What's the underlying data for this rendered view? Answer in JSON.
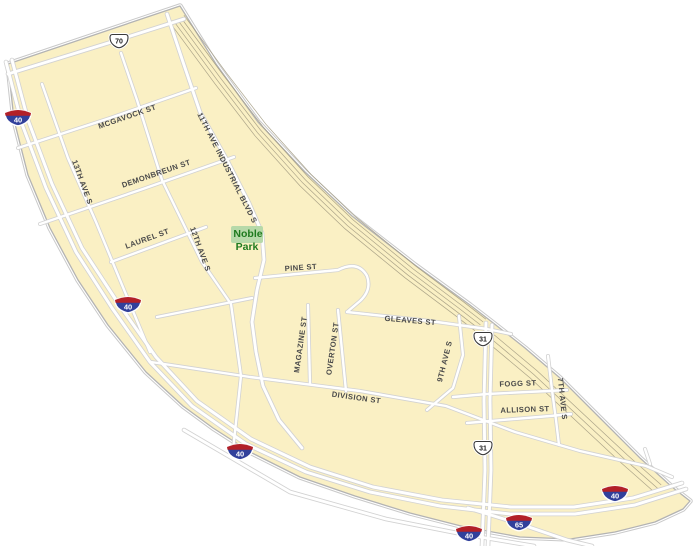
{
  "map": {
    "park": {
      "line1": "Noble",
      "line2": "Park"
    },
    "street_labels": [
      {
        "text": "MCGAVOCK ST",
        "x": 128,
        "y": 119,
        "rotate": -19
      },
      {
        "text": "DEMONBREUN ST",
        "x": 157,
        "y": 176,
        "rotate": -19
      },
      {
        "text": "LAUREL ST",
        "x": 148,
        "y": 241,
        "rotate": -20
      },
      {
        "text": "13TH AVE S",
        "x": 80,
        "y": 183,
        "rotate": 70
      },
      {
        "text": "12TH AVE S",
        "x": 198,
        "y": 250,
        "rotate": 70
      },
      {
        "text": "11TH AVE INDUSTRIAL BLVD S",
        "x": 225,
        "y": 169,
        "rotate": 63
      },
      {
        "text": "PINE ST",
        "x": 301,
        "y": 270,
        "rotate": -4
      },
      {
        "text": "GLEAVES ST",
        "x": 410,
        "y": 323,
        "rotate": 5
      },
      {
        "text": "MAGAZINE ST",
        "x": 303,
        "y": 345,
        "rotate": -82
      },
      {
        "text": "OVERTON ST",
        "x": 335,
        "y": 349,
        "rotate": -82
      },
      {
        "text": "9TH AVE S",
        "x": 447,
        "y": 362,
        "rotate": -76
      },
      {
        "text": "DIVISION ST",
        "x": 356,
        "y": 400,
        "rotate": 8
      },
      {
        "text": "FOGG ST",
        "x": 518,
        "y": 386,
        "rotate": -2
      },
      {
        "text": "ALLISON ST",
        "x": 525,
        "y": 412,
        "rotate": -2
      },
      {
        "text": "7TH AVE S",
        "x": 560,
        "y": 399,
        "rotate": 84
      }
    ],
    "shields": [
      {
        "type": "interstate",
        "label": "40",
        "x": 18,
        "y": 118
      },
      {
        "type": "interstate",
        "label": "40",
        "x": 128,
        "y": 305
      },
      {
        "type": "interstate",
        "label": "40",
        "x": 240,
        "y": 452
      },
      {
        "type": "interstate",
        "label": "40",
        "x": 615,
        "y": 494
      },
      {
        "type": "interstate",
        "label": "40",
        "x": 469,
        "y": 534
      },
      {
        "type": "interstate",
        "label": "65",
        "x": 519,
        "y": 523
      },
      {
        "type": "us",
        "label": "70",
        "x": 119,
        "y": 41
      },
      {
        "type": "us",
        "label": "31",
        "x": 483,
        "y": 339
      },
      {
        "type": "us",
        "label": "31",
        "x": 483,
        "y": 448
      }
    ],
    "colors": {
      "background": "#ffffff",
      "area_fill": "#faf0c4",
      "area_outline": "#b3b3b3",
      "area_outline_outer": "#c9c9c9",
      "road_fill": "#ffffff",
      "road_casing": "#d2d2d2",
      "railroad": "#a39b82",
      "street_label": "#4a4a4a",
      "park_fill": "#b6d9a9",
      "park_label": "#1e7a1e",
      "shield_interstate_blue": "#31409b",
      "shield_interstate_red": "#b22028",
      "shield_us_outline": "#3a3a3a",
      "shield_us_fill": "#ffffff"
    }
  }
}
